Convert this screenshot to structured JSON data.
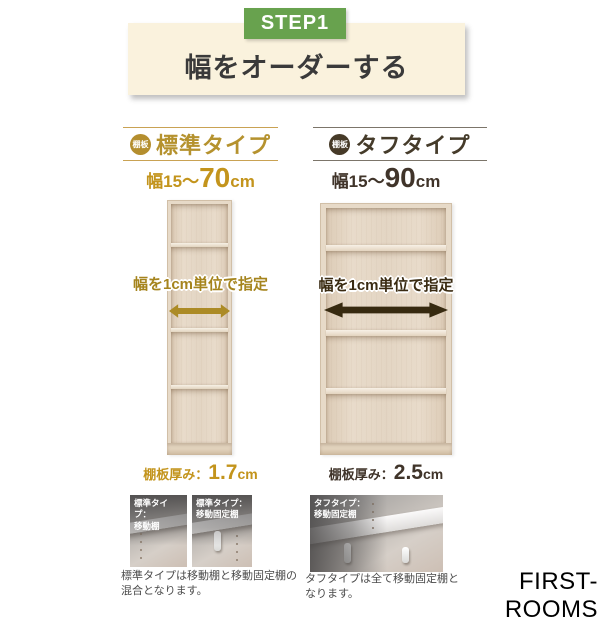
{
  "colors": {
    "step_green": "#68a24e",
    "banner_cream": "#faf2dd",
    "standard_gold": "#b8912f",
    "tough_dark_brown": "#453726",
    "wood_beige": "#e7dac8"
  },
  "step": {
    "badge": "STEP1",
    "title": "幅をオーダーする"
  },
  "standard": {
    "tab_badge": "棚板",
    "type_name": "標準タイプ",
    "width_prefix": "幅15〜",
    "width_value": "70",
    "width_unit": "cm",
    "arrow_label": "幅を1cm単位で指定",
    "thickness_label": "棚板厚み：",
    "thickness_value": "1.7",
    "thickness_unit": "cm",
    "photo1_label": "標準タイプ：\n移動棚",
    "photo2_label": "標準タイプ：\n移動固定棚",
    "caption": "標準タイプは移動棚と移動固定棚の混合となります。"
  },
  "tough": {
    "tab_badge": "棚板",
    "type_name": "タフタイプ",
    "width_prefix": "幅15〜",
    "width_value": "90",
    "width_unit": "cm",
    "arrow_label": "幅を1cm単位で指定",
    "thickness_label": "棚板厚み：",
    "thickness_value": "2.5",
    "thickness_unit": "cm",
    "photo_label": "タフタイプ：\n移動固定棚",
    "caption": "タフタイプは全て移動固定棚となります。"
  },
  "footer": {
    "brand": "FIRST-ROOMS"
  }
}
